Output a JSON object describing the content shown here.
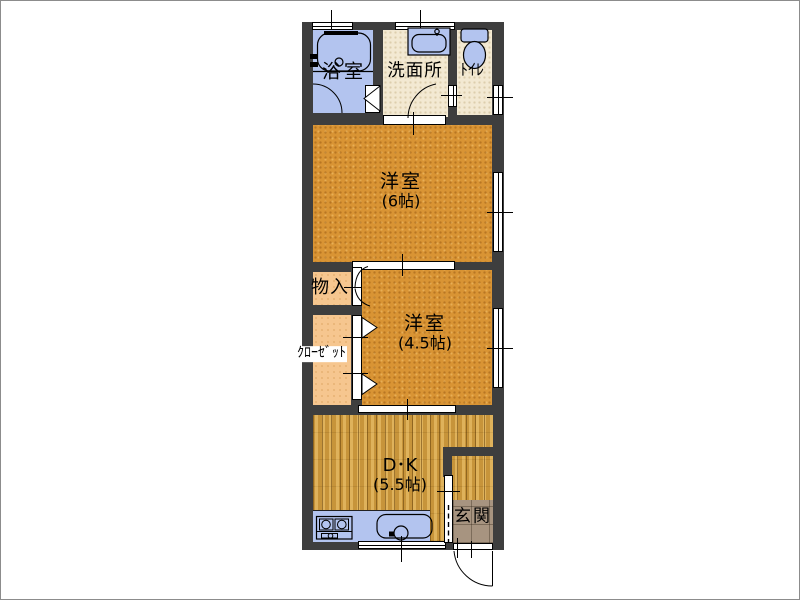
{
  "title": "floorplan",
  "rooms": {
    "bath": {
      "label": "浴室",
      "floor_color": "#b3c4ef"
    },
    "washroom": {
      "label": "洗面所",
      "floor_color": "#f3e9d2"
    },
    "toilet": {
      "label": "ﾄｲﾚ",
      "floor_color": "#f3e9d2"
    },
    "bedroom6": {
      "label": "洋室",
      "size": "(6帖)",
      "floor_color": "#d99434"
    },
    "storage": {
      "label": "物入",
      "floor_color": "#f6c68f"
    },
    "closet": {
      "label": "ｸﾛｰｾﾞｯﾄ",
      "floor_color": "#f6c68f"
    },
    "bedroom45": {
      "label": "洋室",
      "size": "(4.5帖)",
      "floor_color": "#d99434"
    },
    "dining_kitchen": {
      "label": "D･K",
      "size": "(5.5帖)",
      "floor_color": "#d3a144"
    },
    "entrance": {
      "label": "玄関",
      "floor_color": "#a79480"
    }
  },
  "colors": {
    "background": "#ffffff",
    "wall": "#3e3e3e",
    "fixture_blue": "#b3c4ef",
    "frame_border": "#8c8c8c"
  },
  "fixtures": [
    "bathtub",
    "washbasin",
    "toilet",
    "stove",
    "kitchen-sink",
    "kitchen-counter"
  ]
}
